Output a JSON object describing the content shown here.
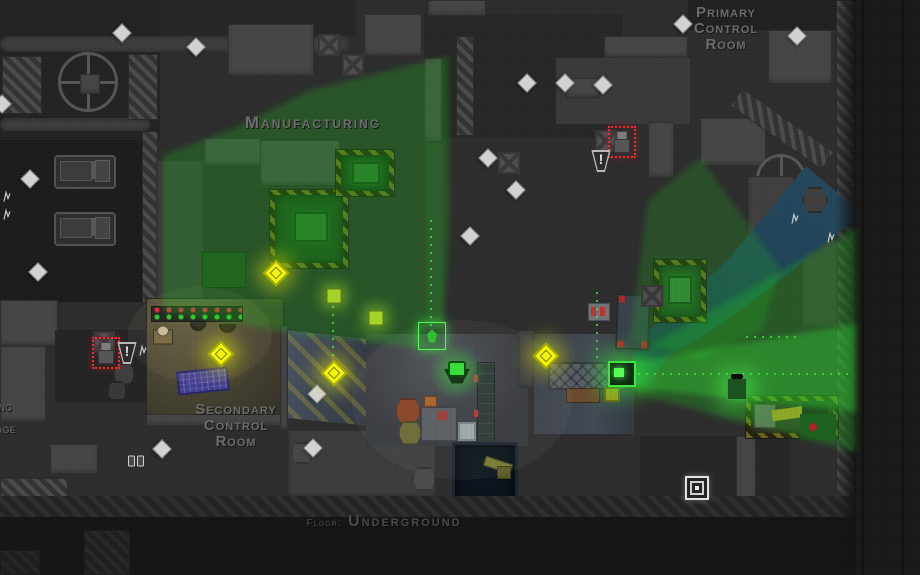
{
  "labels": {
    "primary_room": "Primary\nControl\nRoom",
    "manufacturing": "Manufacturing",
    "secondary_room": "Secondary\nControl\nRoom",
    "floor_prefix": "Floor:",
    "floor_name": "Underground",
    "left_fragment_top": "ing",
    "left_fragment_bottom": "age"
  },
  "icons": {
    "alert_glyph": "!",
    "alert_icon": "exclamation-trapezoid",
    "safe_icon": "concentric-square",
    "pickup_icon": "yellow-diamond",
    "marker_icon": "white-diamond"
  },
  "colors": {
    "vision_cone_green": "#1ad21a",
    "enemy_highlight_red": "#ff2626",
    "pickup_yellow": "#f2f50a",
    "river_blue": "#1d3d4f",
    "label_gray": "#6c6c6c",
    "concrete": "#2d2d2d"
  },
  "entities": [
    {
      "t": "truck",
      "x": 85,
      "y": 172
    },
    {
      "t": "truck",
      "x": 85,
      "y": 229
    },
    {
      "t": "cratex",
      "x": 329,
      "y": 45
    },
    {
      "t": "cratex",
      "x": 353,
      "y": 65
    },
    {
      "t": "cratex",
      "x": 606,
      "y": 141
    },
    {
      "t": "cratex",
      "x": 509,
      "y": 163
    },
    {
      "t": "cratex",
      "x": 652,
      "y": 296
    },
    {
      "t": "cratex",
      "x": 104,
      "y": 342
    },
    {
      "t": "hexe",
      "x": 408,
      "y": 411,
      "c": "#8a4a2a",
      "s": 26
    },
    {
      "t": "hexe",
      "x": 410,
      "y": 433,
      "c": "#6f6f3d",
      "s": 24
    },
    {
      "t": "hexe",
      "x": 424,
      "y": 479,
      "c": "#4c4c4c",
      "s": 24
    },
    {
      "t": "hexe",
      "x": 302,
      "y": 453,
      "c": "#474747",
      "s": 22
    },
    {
      "t": "hexe",
      "x": 815,
      "y": 200,
      "c": "#3f3f3f",
      "s": 26
    },
    {
      "t": "hexe",
      "x": 124,
      "y": 374,
      "c": "#3e3e3e",
      "s": 22
    },
    {
      "t": "hexe",
      "x": 117,
      "y": 391,
      "c": "#393939",
      "s": 20
    },
    {
      "t": "wdiamond",
      "x": 122,
      "y": 33
    },
    {
      "t": "wdiamond",
      "x": 196,
      "y": 47
    },
    {
      "t": "wdiamond",
      "x": 683,
      "y": 24
    },
    {
      "t": "wdiamond",
      "x": 797,
      "y": 36
    },
    {
      "t": "wdiamond",
      "x": 2,
      "y": 104
    },
    {
      "t": "wdiamond",
      "x": 30,
      "y": 179
    },
    {
      "t": "wdiamond",
      "x": 38,
      "y": 272
    },
    {
      "t": "wdiamond",
      "x": 527,
      "y": 83
    },
    {
      "t": "wdiamond",
      "x": 565,
      "y": 83
    },
    {
      "t": "wdiamond",
      "x": 603,
      "y": 85
    },
    {
      "t": "wdiamond",
      "x": 488,
      "y": 158
    },
    {
      "t": "wdiamond",
      "x": 516,
      "y": 190
    },
    {
      "t": "wdiamond",
      "x": 470,
      "y": 236
    },
    {
      "t": "wdiamond",
      "x": 162,
      "y": 449
    },
    {
      "t": "wdiamond",
      "x": 313,
      "y": 448
    },
    {
      "t": "wdiamond",
      "x": 317,
      "y": 394
    },
    {
      "t": "ydiamond",
      "x": 221,
      "y": 354
    },
    {
      "t": "ydiamond",
      "x": 334,
      "y": 373
    },
    {
      "t": "ydiamond",
      "x": 546,
      "y": 356
    },
    {
      "t": "ydiamond",
      "x": 276,
      "y": 273
    },
    {
      "t": "gmachine",
      "x": 334,
      "y": 296
    },
    {
      "t": "gmachine",
      "x": 376,
      "y": 318
    },
    {
      "t": "glowbox",
      "x": 737,
      "y": 389
    },
    {
      "t": "camera",
      "x": 622,
      "y": 374
    },
    {
      "t": "objective",
      "x": 432,
      "y": 336
    },
    {
      "t": "guard",
      "x": 163,
      "y": 334
    },
    {
      "t": "player",
      "x": 457,
      "y": 372
    },
    {
      "t": "enemy",
      "x": 622,
      "y": 142
    },
    {
      "t": "enemy",
      "x": 106,
      "y": 353
    },
    {
      "t": "alert",
      "x": 601,
      "y": 161
    },
    {
      "t": "alert",
      "x": 127,
      "y": 353
    },
    {
      "t": "safe",
      "x": 697,
      "y": 488
    },
    {
      "t": "zigzag",
      "x": 143,
      "y": 353
    },
    {
      "t": "zigzag",
      "x": 795,
      "y": 221
    },
    {
      "t": "zigzag",
      "x": 831,
      "y": 240
    },
    {
      "t": "zigzag",
      "x": 7,
      "y": 199
    },
    {
      "t": "zigzag",
      "x": 7,
      "y": 217
    },
    {
      "t": "dooricon",
      "x": 136,
      "y": 461
    },
    {
      "t": "redmark",
      "x": 813,
      "y": 427
    }
  ]
}
